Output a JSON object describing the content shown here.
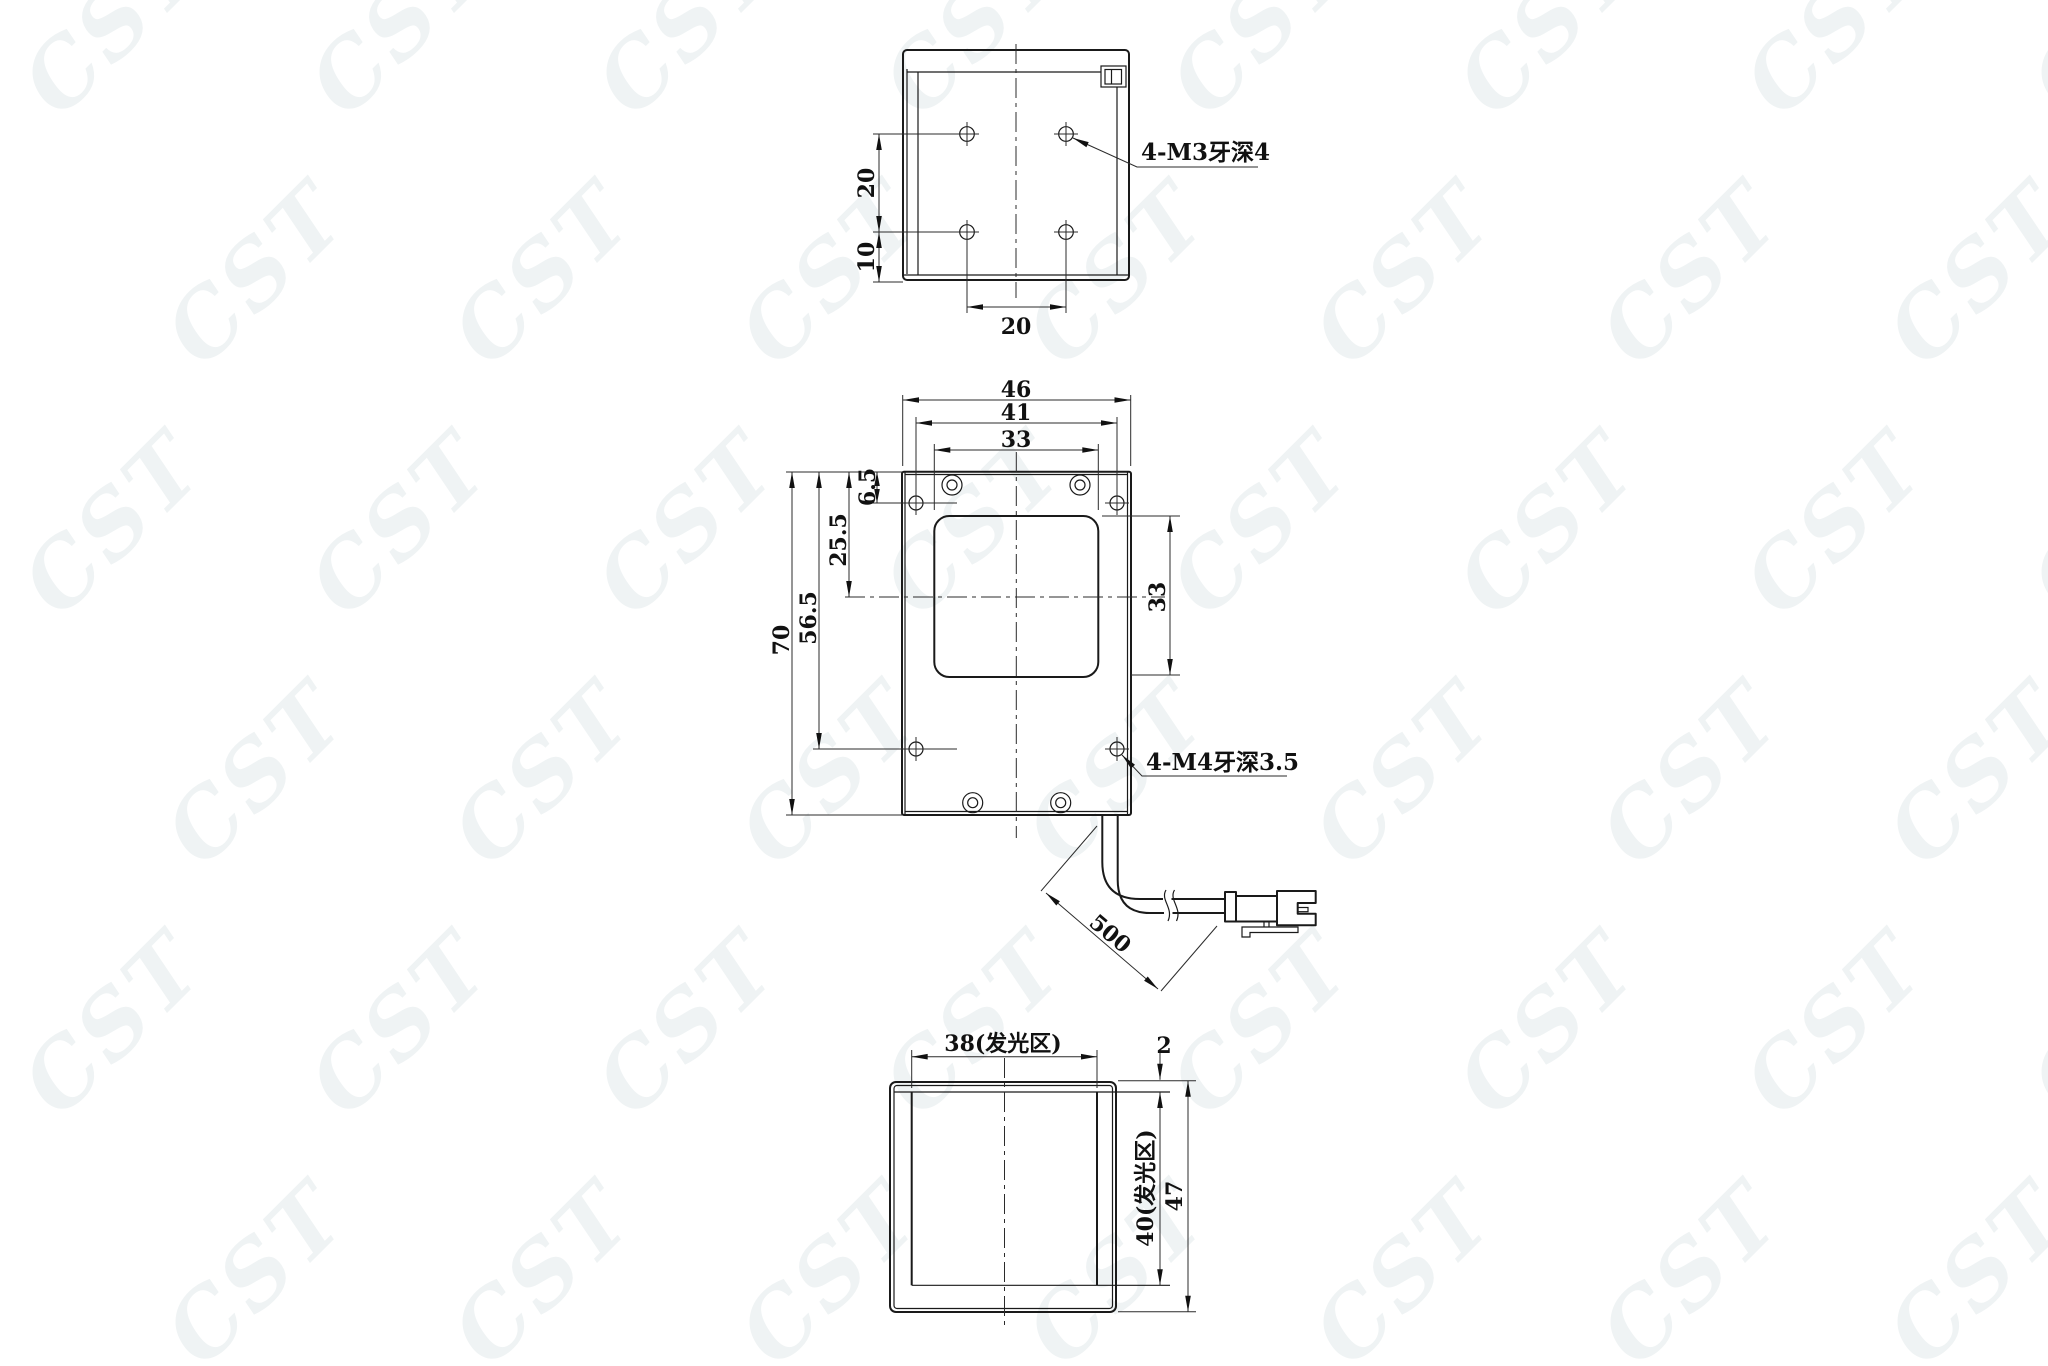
{
  "watermark": {
    "text": "CST"
  },
  "top_view": {
    "dim_hole_spacing_v": "20",
    "dim_hole_to_edge": "10",
    "dim_hole_spacing_h": "20",
    "leader": "4-M3牙深4"
  },
  "front_view": {
    "dim_width": "46",
    "dim_hole_span_h": "41",
    "dim_window_w": "33",
    "dim_edge_offset": "6.5",
    "dim_window_center": "25.5",
    "dim_hole_span_v": "56.5",
    "dim_height": "70",
    "dim_window_h": "33",
    "leader": "4-M4牙深3.5",
    "dim_cable_length": "500"
  },
  "light_view": {
    "dim_window_w": "38(发光区)",
    "dim_bezel_gap": "2",
    "dim_window_h": "40(发光区)",
    "dim_height": "47"
  }
}
